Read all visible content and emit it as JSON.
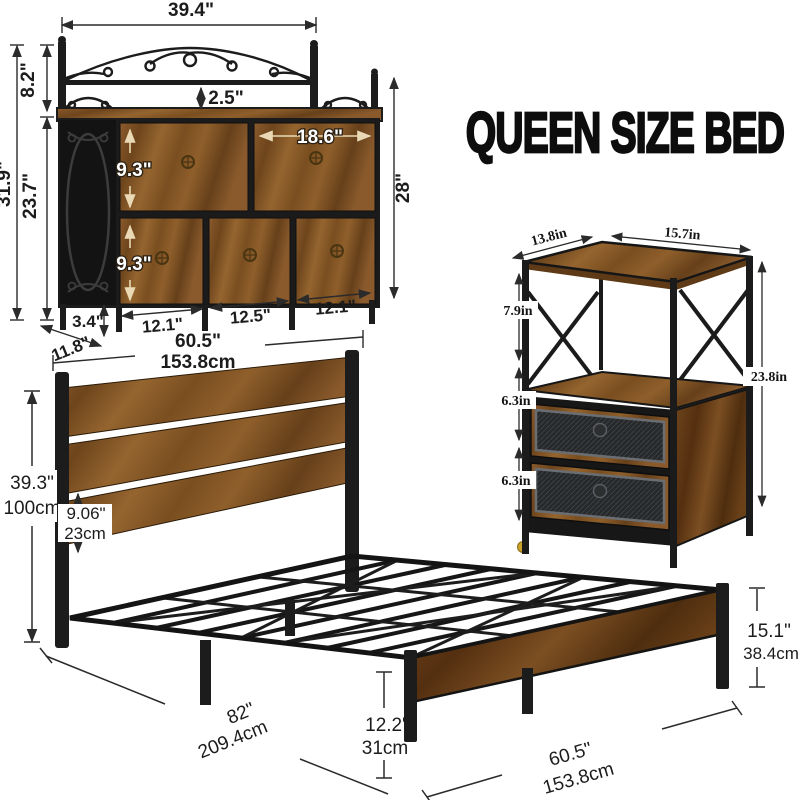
{
  "title": "QUEEN SIZE BED",
  "dresser": {
    "top_width": "39.4\"",
    "shelf_gap": "2.5\"",
    "hutch_height": "8.2\"",
    "total_height": "31.9\"",
    "body_height": "23.7\"",
    "upper_drawer_height": "9.3\"",
    "lower_drawer_height": "9.3\"",
    "upper_right_drawer_width": "18.6\"",
    "right_height": "28\"",
    "leg_height": "3.4\"",
    "depth": "11.8\"",
    "lower_drawer1_width": "12.1\"",
    "lower_drawer2_width": "12.5\"",
    "lower_drawer3_width": "12.1\"",
    "width_in": "60.5\"",
    "width_cm": "153.8cm"
  },
  "nightstand": {
    "depth": "13.8in",
    "width": "15.7in",
    "shelf_height": "7.9in",
    "drawer1_height": "6.3in",
    "drawer2_height": "6.3in",
    "height": "23.8in"
  },
  "bed": {
    "headboard_height_in": "39.3\"",
    "headboard_height_cm": "100cm",
    "under_headboard_in": "9.06\"",
    "under_headboard_cm": "23cm",
    "length_in": "82\"",
    "length_cm": "209.4cm",
    "platform_height_in": "12.2\"",
    "platform_height_cm": "31cm",
    "width_in": "60.5\"",
    "width_cm": "153.8cm",
    "footboard_height_in": "15.1\"",
    "footboard_height_cm": "38.4cm"
  },
  "colors": {
    "wood": "#8a5a2c",
    "wood_dark": "#6b4118",
    "metal": "#1c1c1c",
    "mesh": "#2c2e30",
    "dim_line": "#2b2b2b",
    "accent_arrow": "#ead9b5",
    "gold_pin": "#c9a227"
  }
}
